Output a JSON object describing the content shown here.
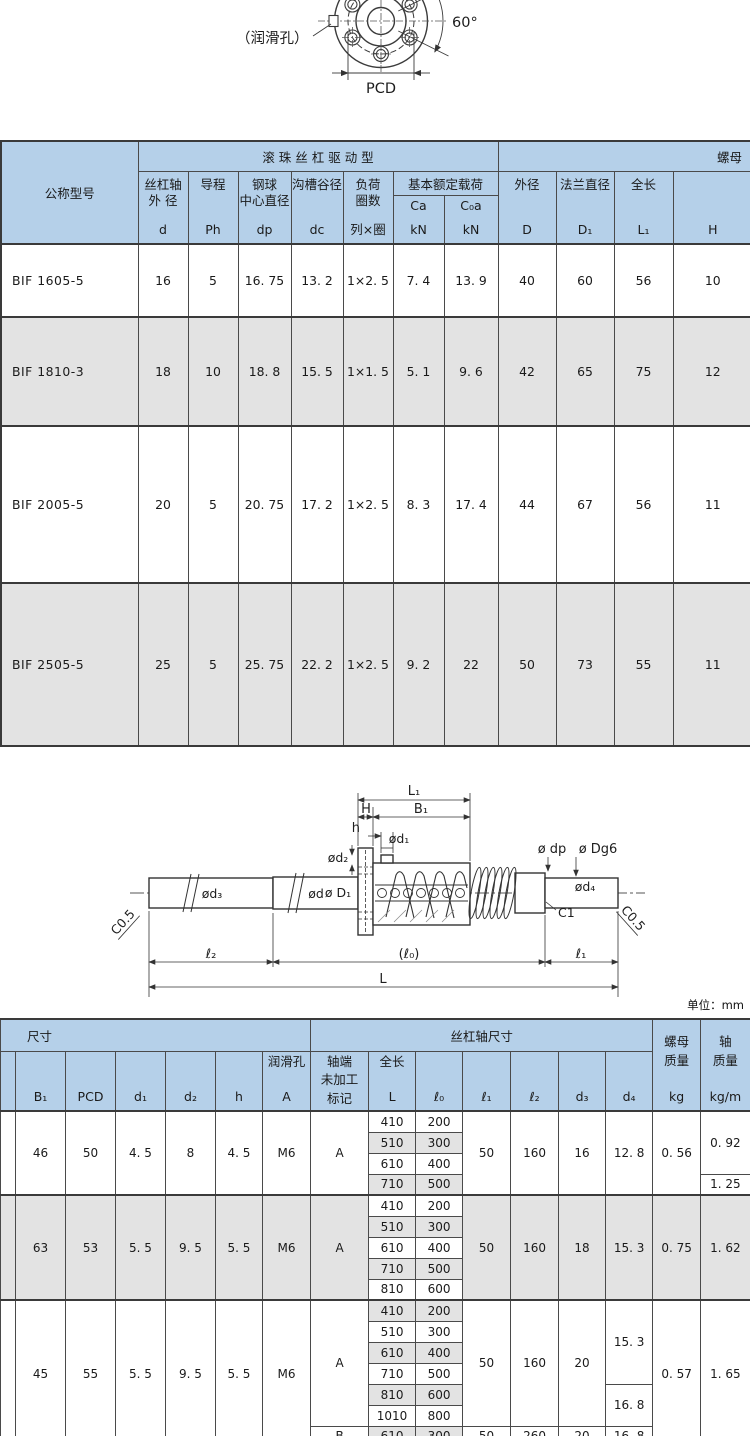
{
  "unit_label": "单位：mm",
  "flange_drawing": {
    "lube_hole_label": "（润滑孔）",
    "angle_label": "60°",
    "pcd_label": "PCD"
  },
  "screw_drawing": {
    "L1": "L₁",
    "H": "H",
    "B1": "B₁",
    "h": "h",
    "phi_d1": "ød₁",
    "phi_d2": "ød₂",
    "phi_dp": "ø dp",
    "phi_Dg6": "ø Dg6",
    "phi_d3": "ød₃",
    "phi_d": "ød",
    "phi_D1": "ø D₁",
    "phi_d4": "ød₄",
    "c05_left": "C0.5",
    "c1": "C1",
    "c05_right": "C0.5",
    "l2": "ℓ₂",
    "l0": "(ℓ₀)",
    "l1": "ℓ₁",
    "L": "L"
  },
  "table1": {
    "header": {
      "model": "公称型号",
      "group_drive": "滚 珠 丝 杠 驱 动 型",
      "group_nut": "螺母",
      "shaft_od_l1": "丝杠轴",
      "shaft_od_l2": "外 径",
      "shaft_od_sym": "d",
      "lead": "导程",
      "lead_sym": "Ph",
      "ball_center_l1": "钢球",
      "ball_center_l2": "中心直径",
      "ball_center_sym": "dp",
      "groove_dia": "沟槽谷径",
      "groove_sym": "dc",
      "load_l1": "负荷",
      "load_l2": "圈数",
      "load_sym": "列×圈",
      "rated_load": "基本额定载荷",
      "ca": "Ca",
      "c0a": "C₀a",
      "kn": "kN",
      "od": "外径",
      "od_sym": "D",
      "flange_dia": "法兰直径",
      "flange_sym": "D₁",
      "length": "全长",
      "length_sym": "L₁",
      "h_sym": "H"
    },
    "rows": [
      {
        "model": "BIF 1605-5",
        "cells": [
          "16",
          "5",
          "16. 75",
          "13. 2",
          "1×2. 5",
          "7. 4",
          "13. 9",
          "40",
          "60",
          "56",
          "10"
        ]
      },
      {
        "model": "BIF 1810-3",
        "cells": [
          "18",
          "10",
          "18. 8",
          "15. 5",
          "1×1. 5",
          "5. 1",
          "9. 6",
          "42",
          "65",
          "75",
          "12"
        ]
      },
      {
        "model": "BIF 2005-5",
        "cells": [
          "20",
          "5",
          "20. 75",
          "17. 2",
          "1×2. 5",
          "8. 3",
          "17. 4",
          "44",
          "67",
          "56",
          "11"
        ]
      },
      {
        "model": "BIF 2505-5",
        "cells": [
          "25",
          "5",
          "25. 75",
          "22. 2",
          "1×2. 5",
          "9. 2",
          "22",
          "50",
          "73",
          "55",
          "11"
        ]
      }
    ]
  },
  "table2": {
    "header": {
      "group_dim": "尺寸",
      "group_shaft": "丝杠轴尺寸",
      "nut_mass_l1": "螺母",
      "nut_mass_l2": "质量",
      "nut_mass_sym": "kg",
      "shaft_mass_l1": "轴",
      "shaft_mass_l2": "质量",
      "shaft_mass_sym": "kg/m",
      "b1": "B₁",
      "pcd": "PCD",
      "d1": "d₁",
      "d2": "d₂",
      "h": "h",
      "lube": "润滑孔",
      "lube_sym": "A",
      "mark_l1": "轴端",
      "mark_l2": "未加工",
      "mark_l3": "标记",
      "total_len": "全长",
      "total_len_sym": "L",
      "l0": "ℓ₀",
      "l1": "ℓ₁",
      "l2": "ℓ₂",
      "d3": "d₃",
      "d4": "d₄"
    },
    "groups": [
      {
        "shade": "white",
        "b1": "46",
        "pcd": "50",
        "d1": "4. 5",
        "d2": "8",
        "h": "4. 5",
        "a": "M6",
        "sections": [
          {
            "mark": "A",
            "pairs": [
              [
                "410",
                "200"
              ],
              [
                "510",
                "300"
              ],
              [
                "610",
                "400"
              ],
              [
                "710",
                "500"
              ]
            ],
            "l1": "50",
            "l2": "160",
            "d3": "16",
            "d4_spans": [
              {
                "v": "12. 8",
                "n": 4
              }
            ]
          }
        ],
        "kg_spans": [
          {
            "v": "0. 56",
            "n": 4
          }
        ],
        "kgm_spans": [
          {
            "v": "0. 92",
            "n": 3
          },
          {
            "v": "1. 25",
            "n": 1
          }
        ]
      },
      {
        "shade": "gray",
        "b1": "63",
        "pcd": "53",
        "d1": "5. 5",
        "d2": "9. 5",
        "h": "5. 5",
        "a": "M6",
        "sections": [
          {
            "mark": "A",
            "pairs": [
              [
                "410",
                "200"
              ],
              [
                "510",
                "300"
              ],
              [
                "610",
                "400"
              ],
              [
                "710",
                "500"
              ],
              [
                "810",
                "600"
              ]
            ],
            "l1": "50",
            "l2": "160",
            "d3": "18",
            "d4_spans": [
              {
                "v": "15. 3",
                "n": 5
              }
            ]
          }
        ],
        "kg_spans": [
          {
            "v": "0. 75",
            "n": 5
          }
        ],
        "kgm_spans": [
          {
            "v": "1. 62",
            "n": 5
          }
        ]
      },
      {
        "shade": "white",
        "b1": "45",
        "pcd": "55",
        "d1": "5. 5",
        "d2": "9. 5",
        "h": "5. 5",
        "a": "M6",
        "sections": [
          {
            "mark": "A",
            "pairs": [
              [
                "410",
                "200"
              ],
              [
                "510",
                "300"
              ],
              [
                "610",
                "400"
              ],
              [
                "710",
                "500"
              ],
              [
                "810",
                "600"
              ],
              [
                "1010",
                "800"
              ]
            ],
            "l1": "50",
            "l2": "160",
            "d3": "20",
            "d4_spans": [
              {
                "v": "15. 3",
                "n": 4
              },
              {
                "v": "16. 8",
                "n": 2
              }
            ]
          },
          {
            "mark": "B",
            "pairs": [
              [
                "610",
                "300"
              ]
            ],
            "l1": "50",
            "l2": "260",
            "d3": "20",
            "d4_spans": [
              {
                "v": "16. 8",
                "n": 1
              }
            ]
          }
        ],
        "kg_spans": [
          {
            "v": "0. 57",
            "n": 7
          }
        ],
        "kgm_spans": [
          {
            "v": "1. 65",
            "n": 7
          }
        ]
      }
    ]
  }
}
